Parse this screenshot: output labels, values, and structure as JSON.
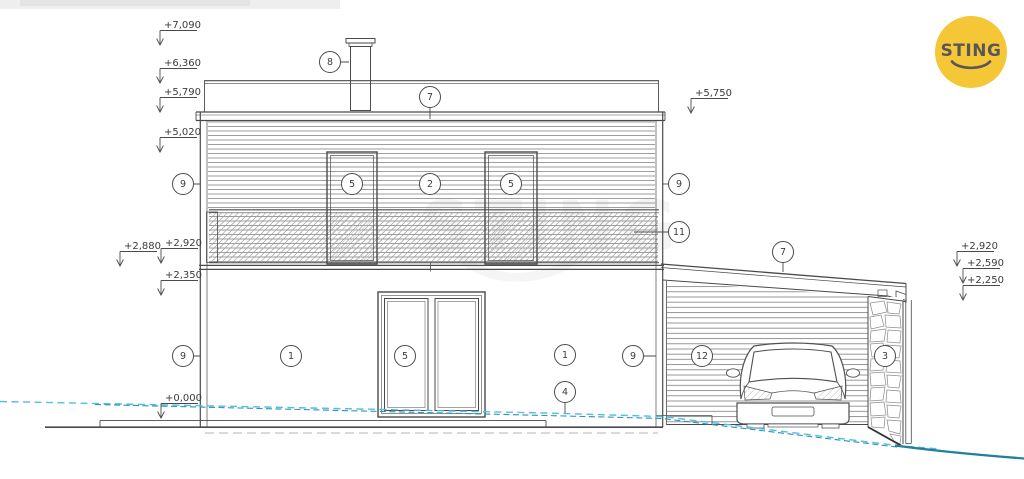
{
  "logo": {
    "text": "STING",
    "bg_color": "#f5c636",
    "fg_color": "#57575a"
  },
  "watermark": {
    "text": "STING"
  },
  "drawing": {
    "line_color": "#4a4a4a",
    "terrain": {
      "dashed_light": "#54bedf",
      "dashed_dark": "#2a92b5",
      "solid": "#20809d",
      "ground_dash": "#b5b5b5"
    },
    "elevation_marks": [
      {
        "label": "+7,090",
        "x": 160,
        "y": 28
      },
      {
        "label": "+6,360",
        "x": 160,
        "y": 66
      },
      {
        "label": "+5,790",
        "x": 160,
        "y": 95
      },
      {
        "label": "+5,020",
        "x": 160,
        "y": 135
      },
      {
        "label": "+2,880",
        "x": 120,
        "y": 249
      },
      {
        "label": "+2,920",
        "x": 161,
        "y": 246
      },
      {
        "label": "+2,350",
        "x": 161,
        "y": 278
      },
      {
        "label": "+0,000",
        "x": 161,
        "y": 401
      },
      {
        "label": "+5,750",
        "x": 691,
        "y": 96
      },
      {
        "label": "+2,920",
        "x": 957,
        "y": 249
      },
      {
        "label": "+2,590",
        "x": 963,
        "y": 266
      },
      {
        "label": "+2,250",
        "x": 963,
        "y": 283
      }
    ],
    "callouts": [
      {
        "label": "8",
        "x": 330,
        "y": 62,
        "lx": 349,
        "ly": 62
      },
      {
        "label": "7",
        "x": 430,
        "y": 97,
        "lx": 430,
        "ly": 119
      },
      {
        "label": "7",
        "x": 783,
        "y": 252,
        "lx": 783,
        "ly": 272
      },
      {
        "label": "9",
        "x": 183,
        "y": 184,
        "lx": 200,
        "ly": 184
      },
      {
        "label": "9",
        "x": 679,
        "y": 184,
        "lx": 663,
        "ly": 184
      },
      {
        "label": "11",
        "x": 679,
        "y": 232,
        "lx": 634,
        "ly": 232
      },
      {
        "label": "2",
        "x": 430,
        "y": 184
      },
      {
        "label": "5",
        "x": 352,
        "y": 184
      },
      {
        "label": "5",
        "x": 511,
        "y": 184
      },
      {
        "label": "5",
        "x": 405,
        "y": 356
      },
      {
        "label": "1",
        "x": 291,
        "y": 356
      },
      {
        "label": "1",
        "x": 565,
        "y": 355
      },
      {
        "label": "9",
        "x": 183,
        "y": 356,
        "lx": 200,
        "ly": 356
      },
      {
        "label": "9",
        "x": 633,
        "y": 356,
        "lx": 656,
        "ly": 356
      },
      {
        "label": "4",
        "x": 565,
        "y": 392,
        "lx": 565,
        "ly": 413
      },
      {
        "label": "12",
        "x": 702,
        "y": 356
      },
      {
        "label": "3",
        "x": 885,
        "y": 356
      }
    ]
  }
}
